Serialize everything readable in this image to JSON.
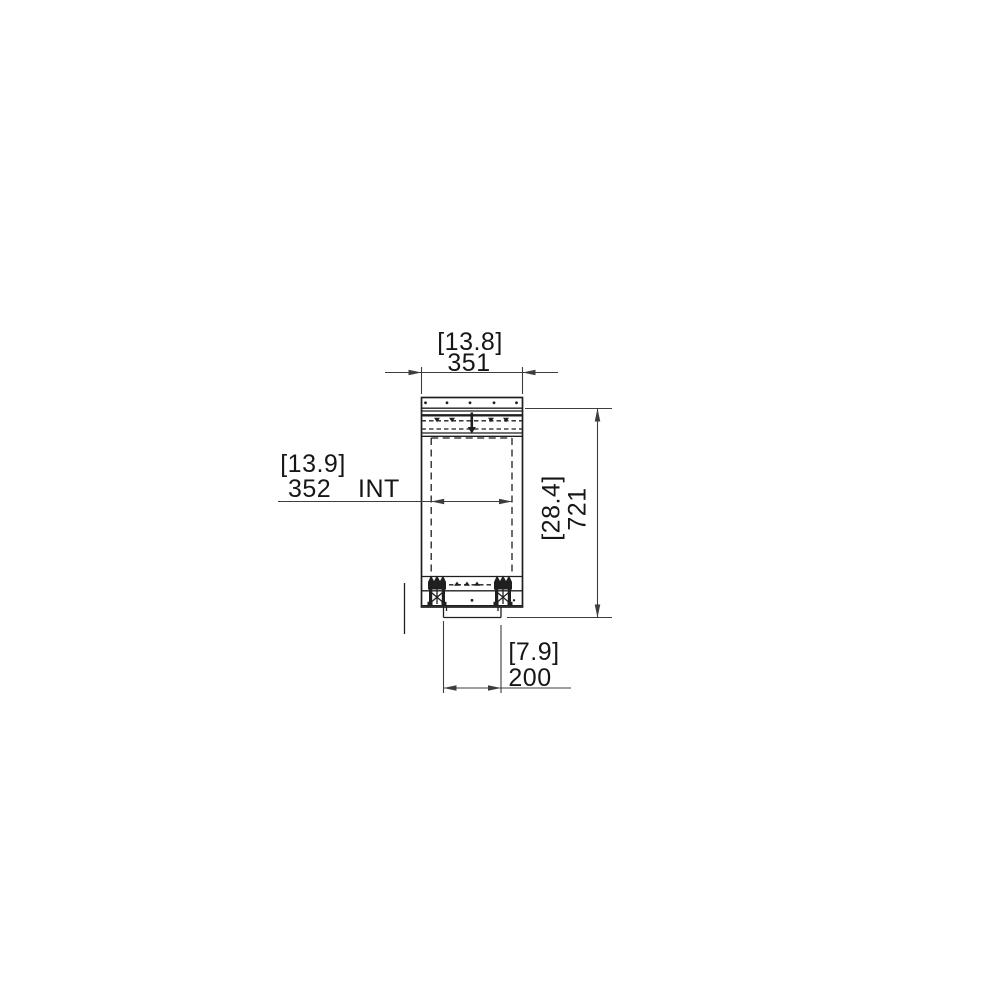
{
  "colors": {
    "background": "#ffffff",
    "object_line": "#1f1f1f",
    "dimension_line": "#3d3d3d",
    "text": "#161616"
  },
  "dimensions": {
    "top_width": {
      "converted": "[13.8]",
      "value": "351"
    },
    "internal_width": {
      "converted": "[13.9]",
      "value": "352",
      "suffix": "INT"
    },
    "overall_height": {
      "converted": "[28.4]",
      "value": "721"
    },
    "bottom_width": {
      "converted": "[7.9]",
      "value": "200"
    }
  }
}
